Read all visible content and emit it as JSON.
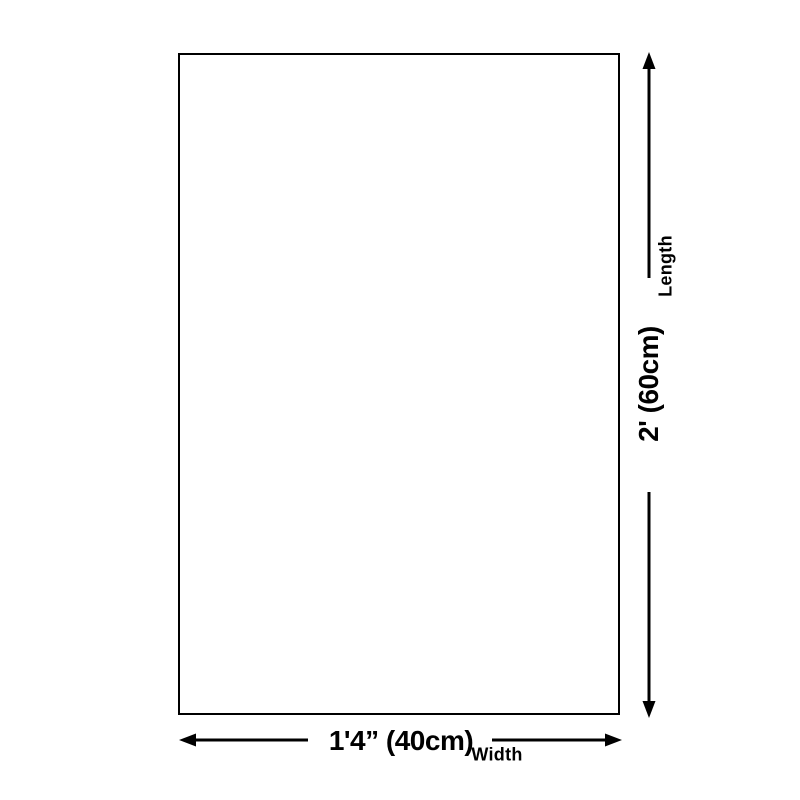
{
  "diagram": {
    "background_color": "#ffffff",
    "line_color": "#000000",
    "text_color": "#000000",
    "product_outline": {
      "shape": "rectangle",
      "fill": "#ffffff",
      "border": "#000000"
    },
    "length": {
      "label": "Length",
      "value": "2' (60cm)"
    },
    "width": {
      "label": "Width",
      "value": "1'4” (40cm)"
    }
  }
}
